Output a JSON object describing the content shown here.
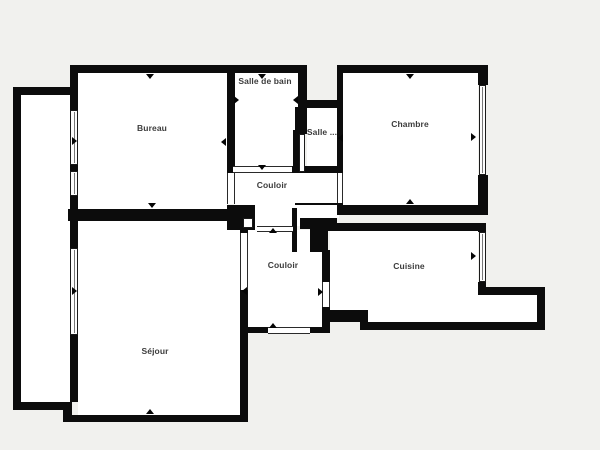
{
  "plan": {
    "canvas": {
      "width": 600,
      "height": 450,
      "background_color": "#f1f1ee",
      "wall_color": "#0c0c0c",
      "floor_color": "#ffffff"
    },
    "rooms": [
      {
        "name": "bureau",
        "label": "Bureau",
        "lx": 152,
        "ly": 128
      },
      {
        "name": "salle-de-bain",
        "label": "Salle de bain",
        "lx": 265,
        "ly": 81
      },
      {
        "name": "salle",
        "label": "Salle ...",
        "lx": 322,
        "ly": 132
      },
      {
        "name": "chambre",
        "label": "Chambre",
        "lx": 410,
        "ly": 124
      },
      {
        "name": "couloir-haut",
        "label": "Couloir",
        "lx": 272,
        "ly": 185
      },
      {
        "name": "couloir-bas",
        "label": "Couloir",
        "lx": 283,
        "ly": 265
      },
      {
        "name": "cuisine",
        "label": "Cuisine",
        "lx": 409,
        "ly": 266
      },
      {
        "name": "sejour",
        "label": "Séjour",
        "lx": 155,
        "ly": 351
      }
    ],
    "elements": [
      {
        "t": "f",
        "n": "floor-loggia",
        "x": 21,
        "y": 95,
        "w": 49,
        "h": 307
      },
      {
        "t": "f",
        "n": "floor-bureau",
        "x": 78,
        "y": 73,
        "w": 149,
        "h": 136
      },
      {
        "t": "f",
        "n": "floor-salle-de-bain",
        "x": 235,
        "y": 73,
        "w": 63,
        "h": 93
      },
      {
        "t": "f",
        "n": "floor-salle",
        "x": 307,
        "y": 108,
        "w": 30,
        "h": 58
      },
      {
        "t": "f",
        "n": "floor-chambre",
        "x": 343,
        "y": 73,
        "w": 135,
        "h": 132
      },
      {
        "t": "f",
        "n": "floor-couloir-haut",
        "x": 235,
        "y": 173,
        "w": 102,
        "h": 53
      },
      {
        "t": "f",
        "n": "floor-alcove",
        "x": 295,
        "y": 205,
        "w": 44,
        "h": 13
      },
      {
        "t": "f",
        "n": "floor-connector",
        "x": 255,
        "y": 205,
        "w": 40,
        "h": 25
      },
      {
        "t": "f",
        "n": "floor-couloir-bas",
        "x": 248,
        "y": 230,
        "w": 74,
        "h": 97
      },
      {
        "t": "f",
        "n": "floor-cuisine",
        "x": 330,
        "y": 231,
        "w": 148,
        "h": 91
      },
      {
        "t": "f",
        "n": "floor-cuisine-nook",
        "x": 478,
        "y": 295,
        "w": 59,
        "h": 27
      },
      {
        "t": "f",
        "n": "floor-sejour",
        "x": 78,
        "y": 221,
        "w": 162,
        "h": 194
      },
      {
        "t": "w",
        "n": "wall-outer-left",
        "x": 13,
        "y": 87,
        "w": 8,
        "h": 323
      },
      {
        "t": "w",
        "n": "wall-loggia-top",
        "x": 13,
        "y": 87,
        "w": 60,
        "h": 8
      },
      {
        "t": "w",
        "n": "wall-loggia-bottom",
        "x": 13,
        "y": 402,
        "w": 57,
        "h": 8
      },
      {
        "t": "w",
        "n": "wall-top",
        "x": 70,
        "y": 65,
        "w": 237,
        "h": 8
      },
      {
        "t": "w",
        "n": "wall",
        "x": 70,
        "y": 65,
        "w": 8,
        "h": 45
      },
      {
        "t": "w",
        "n": "wall",
        "x": 70,
        "y": 165,
        "w": 8,
        "h": 6
      },
      {
        "t": "w",
        "n": "wall",
        "x": 70,
        "y": 196,
        "w": 8,
        "h": 25
      },
      {
        "t": "w",
        "n": "wall",
        "x": 70,
        "y": 221,
        "w": 8,
        "h": 27
      },
      {
        "t": "w",
        "n": "wall",
        "x": 70,
        "y": 335,
        "w": 8,
        "h": 67
      },
      {
        "t": "w",
        "n": "wall-bureau-right",
        "x": 227,
        "y": 65,
        "w": 8,
        "h": 108
      },
      {
        "t": "w",
        "n": "wall-junction",
        "x": 227,
        "y": 205,
        "w": 28,
        "h": 25
      },
      {
        "t": "w",
        "n": "wall-bureau-sejour",
        "x": 68,
        "y": 209,
        "w": 172,
        "h": 12
      },
      {
        "t": "w",
        "n": "wall",
        "x": 298,
        "y": 65,
        "w": 9,
        "h": 42
      },
      {
        "t": "w",
        "n": "wall-salle-top",
        "x": 303,
        "y": 100,
        "w": 40,
        "h": 8
      },
      {
        "t": "w",
        "n": "wall",
        "x": 295,
        "y": 107,
        "w": 12,
        "h": 27
      },
      {
        "t": "w",
        "n": "wall",
        "x": 293,
        "y": 130,
        "w": 6,
        "h": 42
      },
      {
        "t": "w",
        "n": "wall",
        "x": 292,
        "y": 166,
        "w": 51,
        "h": 7
      },
      {
        "t": "w",
        "n": "wall-chambre-top",
        "x": 337,
        "y": 65,
        "w": 151,
        "h": 8
      },
      {
        "t": "w",
        "n": "wall-chambre-left",
        "x": 337,
        "y": 65,
        "w": 6,
        "h": 108
      },
      {
        "t": "w",
        "n": "wall",
        "x": 337,
        "y": 203,
        "w": 6,
        "h": 12
      },
      {
        "t": "w",
        "n": "wall",
        "x": 478,
        "y": 65,
        "w": 10,
        "h": 20
      },
      {
        "t": "w",
        "n": "wall",
        "x": 478,
        "y": 175,
        "w": 10,
        "h": 40
      },
      {
        "t": "w",
        "n": "wall-chambre-bottom",
        "x": 337,
        "y": 205,
        "w": 151,
        "h": 10
      },
      {
        "t": "w",
        "n": "wall-thin-alcove",
        "x": 295,
        "y": 203,
        "w": 44,
        "h": 2
      },
      {
        "t": "w",
        "n": "wall-duct-bar",
        "x": 300,
        "y": 218,
        "w": 37,
        "h": 11
      },
      {
        "t": "w",
        "n": "wall-duct-stem",
        "x": 310,
        "y": 229,
        "w": 18,
        "h": 23
      },
      {
        "t": "w",
        "n": "wall",
        "x": 292,
        "y": 208,
        "w": 5,
        "h": 44
      },
      {
        "t": "w",
        "n": "wall-sejour-right",
        "x": 240,
        "y": 221,
        "w": 8,
        "h": 12
      },
      {
        "t": "w",
        "n": "wall-sejour-right",
        "x": 240,
        "y": 290,
        "w": 8,
        "h": 132
      },
      {
        "t": "w",
        "n": "wall-couloir-cuisine",
        "x": 322,
        "y": 250,
        "w": 8,
        "h": 32
      },
      {
        "t": "w",
        "n": "wall-couloir-cuisine",
        "x": 322,
        "y": 307,
        "w": 8,
        "h": 26
      },
      {
        "t": "w",
        "n": "wall-entrance-left",
        "x": 240,
        "y": 327,
        "w": 28,
        "h": 6
      },
      {
        "t": "w",
        "n": "wall-entrance-right",
        "x": 310,
        "y": 327,
        "w": 20,
        "h": 6
      },
      {
        "t": "w",
        "n": "wall-cuisine-top",
        "x": 322,
        "y": 223,
        "w": 164,
        "h": 8
      },
      {
        "t": "w",
        "n": "wall",
        "x": 478,
        "y": 223,
        "w": 8,
        "h": 9
      },
      {
        "t": "w",
        "n": "wall",
        "x": 478,
        "y": 282,
        "w": 8,
        "h": 13
      },
      {
        "t": "w",
        "n": "wall-nook-top",
        "x": 478,
        "y": 287,
        "w": 67,
        "h": 8
      },
      {
        "t": "w",
        "n": "wall-nook-right",
        "x": 537,
        "y": 287,
        "w": 8,
        "h": 43
      },
      {
        "t": "w",
        "n": "wall-cuisine-bottom",
        "x": 360,
        "y": 322,
        "w": 185,
        "h": 8
      },
      {
        "t": "w",
        "n": "wall-step",
        "x": 360,
        "y": 310,
        "w": 8,
        "h": 20
      },
      {
        "t": "w",
        "n": "wall",
        "x": 322,
        "y": 310,
        "w": 46,
        "h": 12
      },
      {
        "t": "w",
        "n": "wall-sejour-step",
        "x": 63,
        "y": 402,
        "w": 9,
        "h": 20
      },
      {
        "t": "w",
        "n": "wall-sejour-bottom",
        "x": 63,
        "y": 415,
        "w": 180,
        "h": 7
      },
      {
        "t": "n",
        "n": "niche-duct",
        "x": 299,
        "y": 134,
        "w": 6,
        "h": 38
      },
      {
        "t": "n",
        "n": "niche-junction",
        "x": 243,
        "y": 218,
        "w": 10,
        "h": 10
      },
      {
        "t": "oh",
        "n": "opening-salle-de-bain",
        "x": 233,
        "y": 166,
        "w": 59,
        "h": 7
      },
      {
        "t": "oh",
        "n": "opening-couloirs",
        "x": 257,
        "y": 226,
        "w": 36,
        "h": 6
      },
      {
        "t": "oh",
        "n": "door-entrance",
        "x": 268,
        "y": 327,
        "w": 42,
        "h": 7
      },
      {
        "t": "ov",
        "n": "door-bureau",
        "x": 227,
        "y": 173,
        "w": 8,
        "h": 31
      },
      {
        "t": "ov",
        "n": "door-chambre",
        "x": 337,
        "y": 173,
        "w": 6,
        "h": 30
      },
      {
        "t": "ov",
        "n": "door-sejour",
        "x": 240,
        "y": 233,
        "w": 8,
        "h": 57
      },
      {
        "t": "ov",
        "n": "door-cuisine",
        "x": 322,
        "y": 282,
        "w": 8,
        "h": 25
      },
      {
        "t": "win",
        "n": "window-bureau-1",
        "x": 70,
        "y": 110,
        "w": 8,
        "h": 55
      },
      {
        "t": "win",
        "n": "window-bureau-2",
        "x": 70,
        "y": 171,
        "w": 8,
        "h": 25
      },
      {
        "t": "win",
        "n": "window-sejour",
        "x": 70,
        "y": 248,
        "w": 8,
        "h": 87
      },
      {
        "t": "win",
        "n": "window-chambre",
        "x": 479,
        "y": 85,
        "w": 7,
        "h": 90
      },
      {
        "t": "win",
        "n": "window-cuisine",
        "x": 479,
        "y": 232,
        "w": 7,
        "h": 50
      },
      {
        "t": "mk",
        "n": "marker",
        "x": 150,
        "y": 76,
        "d": "d"
      },
      {
        "t": "mk",
        "n": "marker",
        "x": 223,
        "y": 142,
        "d": "l"
      },
      {
        "t": "mk",
        "n": "marker",
        "x": 75,
        "y": 141,
        "d": "r"
      },
      {
        "t": "mk",
        "n": "marker",
        "x": 152,
        "y": 205,
        "d": "d"
      },
      {
        "t": "mk",
        "n": "marker",
        "x": 262,
        "y": 76,
        "d": "d"
      },
      {
        "t": "mk",
        "n": "marker",
        "x": 237,
        "y": 100,
        "d": "r"
      },
      {
        "t": "mk",
        "n": "marker",
        "x": 295,
        "y": 100,
        "d": "l"
      },
      {
        "t": "mk",
        "n": "marker",
        "x": 262,
        "y": 167,
        "d": "d"
      },
      {
        "t": "mk",
        "n": "marker",
        "x": 410,
        "y": 76,
        "d": "d"
      },
      {
        "t": "mk",
        "n": "marker",
        "x": 340,
        "y": 138,
        "d": "l"
      },
      {
        "t": "mk",
        "n": "marker",
        "x": 474,
        "y": 137,
        "d": "r"
      },
      {
        "t": "mk",
        "n": "marker",
        "x": 410,
        "y": 202,
        "d": "u"
      },
      {
        "t": "mk",
        "n": "marker",
        "x": 273,
        "y": 231,
        "d": "u"
      },
      {
        "t": "mk",
        "n": "marker",
        "x": 244,
        "y": 291,
        "d": "l"
      },
      {
        "t": "mk",
        "n": "marker",
        "x": 321,
        "y": 292,
        "d": "r"
      },
      {
        "t": "mk",
        "n": "marker",
        "x": 273,
        "y": 326,
        "d": "u"
      },
      {
        "t": "mk",
        "n": "marker",
        "x": 474,
        "y": 256,
        "d": "r"
      },
      {
        "t": "mk",
        "n": "marker",
        "x": 75,
        "y": 291,
        "d": "r"
      },
      {
        "t": "mk",
        "n": "marker",
        "x": 150,
        "y": 412,
        "d": "u"
      }
    ]
  }
}
